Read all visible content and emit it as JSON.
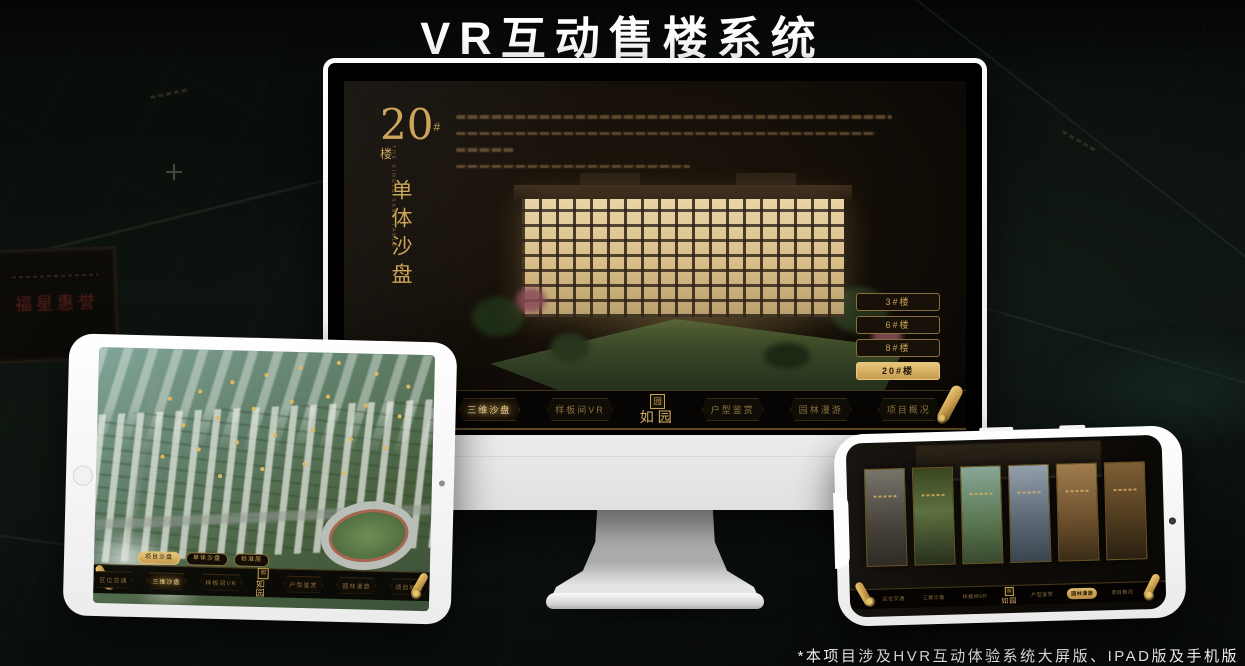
{
  "page": {
    "title": "VR互动售楼系统",
    "footnote": "*本项目涉及HVR互动体验系统大屏版、IPAD版及手机版"
  },
  "colors": {
    "gold": "#c9a254",
    "gold_bright": "#f0d391",
    "active_pill_bg": "#d9b266",
    "screen_bg": "#120d07",
    "page_bg": "#0b100c"
  },
  "background": {
    "plaque_text": "福星惠誉"
  },
  "sandbox_header": {
    "block_number": "20",
    "block_suffix": "#楼",
    "block_subtitle": "单体沙盘",
    "block_subtitle_en": "THE SINGLE SAND TABLE"
  },
  "floors": [
    {
      "label": "3#楼"
    },
    {
      "label": "6#楼"
    },
    {
      "label": "8#楼"
    },
    {
      "label": "20#楼"
    }
  ],
  "tabs": [
    {
      "label": "项目沙盘"
    },
    {
      "label": "单体沙盘"
    },
    {
      "label": "标准层"
    }
  ],
  "menu": {
    "logo": "如园",
    "logo_seal": "园",
    "items": [
      {
        "label": "区位交通"
      },
      {
        "label": "三维沙盘"
      },
      {
        "label": "样板间VR"
      },
      {
        "label": "户型鉴赏"
      },
      {
        "label": "园林漫游"
      },
      {
        "label": "项目概况"
      }
    ]
  }
}
